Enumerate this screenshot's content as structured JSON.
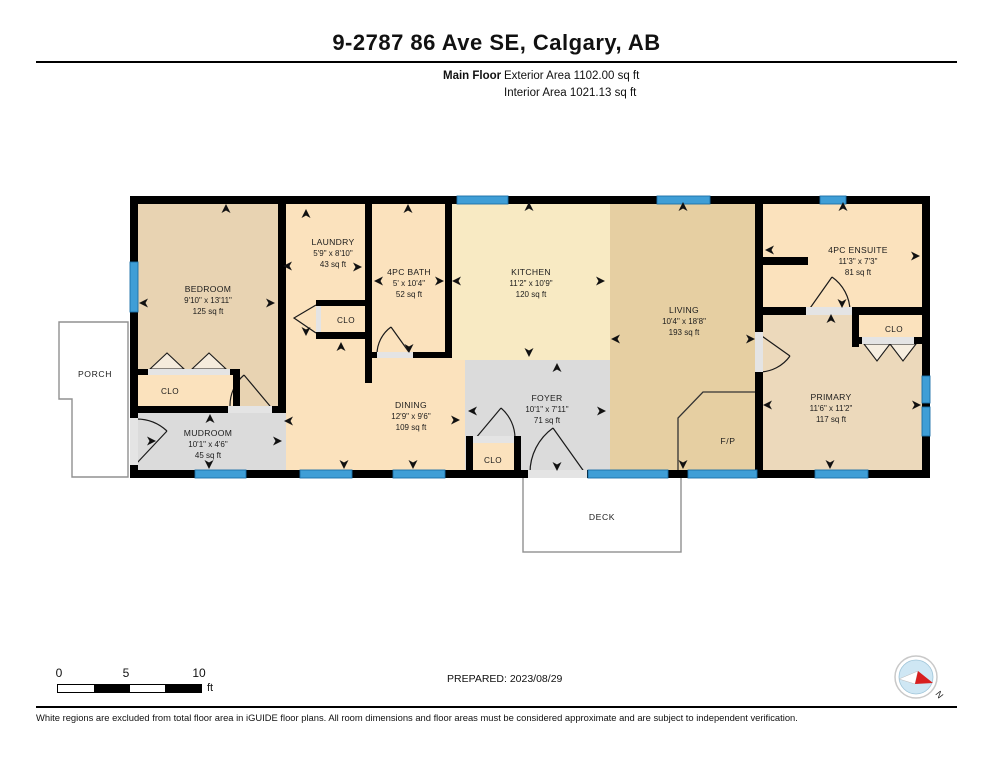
{
  "header": {
    "title": "9-2787 86 Ave SE, Calgary, AB",
    "floor_label": "Main Floor",
    "exterior_area": "Exterior Area 1102.00 sq ft",
    "interior_area": "Interior Area 1021.13 sq ft"
  },
  "plan": {
    "rooms": [
      {
        "name": "BEDROOM",
        "dims": "9'10\" x 13'11\"",
        "area": "125 sq ft"
      },
      {
        "name": "LAUNDRY",
        "dims": "5'9\" x 8'10\"",
        "area": "43 sq ft"
      },
      {
        "name": "4PC BATH",
        "dims": "5' x 10'4\"",
        "area": "52 sq ft"
      },
      {
        "name": "KITCHEN",
        "dims": "11'2\" x 10'9\"",
        "area": "120 sq ft"
      },
      {
        "name": "LIVING",
        "dims": "10'4\" x 18'8\"",
        "area": "193 sq ft"
      },
      {
        "name": "4PC ENSUITE",
        "dims": "11'3\" x 7'3\"",
        "area": "81 sq ft"
      },
      {
        "name": "PRIMARY",
        "dims": "11'6\" x 11'2\"",
        "area": "117 sq ft"
      },
      {
        "name": "DINING",
        "dims": "12'9\" x 9'6\"",
        "area": "109 sq ft"
      },
      {
        "name": "FOYER",
        "dims": "10'1\" x 7'11\"",
        "area": "71 sq ft"
      },
      {
        "name": "MUDROOM",
        "dims": "10'1\" x 4'6\"",
        "area": "45 sq ft"
      }
    ],
    "labels": {
      "closet": "CLO",
      "porch": "PORCH",
      "deck": "DECK",
      "fireplace": "F/P"
    },
    "arrows": [
      {
        "x": 226,
        "y": 209,
        "d": "up"
      },
      {
        "x": 144,
        "y": 303,
        "d": "left"
      },
      {
        "x": 270,
        "y": 303,
        "d": "right"
      },
      {
        "x": 210,
        "y": 419,
        "d": "up"
      },
      {
        "x": 209,
        "y": 464,
        "d": "down"
      },
      {
        "x": 277,
        "y": 441,
        "d": "right"
      },
      {
        "x": 151,
        "y": 441,
        "d": "right"
      },
      {
        "x": 306,
        "y": 214,
        "d": "up"
      },
      {
        "x": 288,
        "y": 266,
        "d": "left"
      },
      {
        "x": 357,
        "y": 267,
        "d": "right"
      },
      {
        "x": 306,
        "y": 331,
        "d": "down"
      },
      {
        "x": 341,
        "y": 347,
        "d": "up"
      },
      {
        "x": 408,
        "y": 209,
        "d": "up"
      },
      {
        "x": 379,
        "y": 281,
        "d": "left"
      },
      {
        "x": 439,
        "y": 281,
        "d": "right"
      },
      {
        "x": 409,
        "y": 348,
        "d": "down"
      },
      {
        "x": 529,
        "y": 207,
        "d": "up"
      },
      {
        "x": 457,
        "y": 281,
        "d": "left"
      },
      {
        "x": 600,
        "y": 281,
        "d": "right"
      },
      {
        "x": 529,
        "y": 352,
        "d": "down"
      },
      {
        "x": 557,
        "y": 368,
        "d": "up"
      },
      {
        "x": 473,
        "y": 411,
        "d": "left"
      },
      {
        "x": 601,
        "y": 411,
        "d": "right"
      },
      {
        "x": 557,
        "y": 466,
        "d": "down"
      },
      {
        "x": 289,
        "y": 421,
        "d": "left"
      },
      {
        "x": 455,
        "y": 420,
        "d": "right"
      },
      {
        "x": 344,
        "y": 464,
        "d": "down"
      },
      {
        "x": 413,
        "y": 464,
        "d": "down"
      },
      {
        "x": 683,
        "y": 207,
        "d": "up"
      },
      {
        "x": 616,
        "y": 339,
        "d": "left"
      },
      {
        "x": 750,
        "y": 339,
        "d": "right"
      },
      {
        "x": 683,
        "y": 464,
        "d": "down"
      },
      {
        "x": 843,
        "y": 207,
        "d": "up"
      },
      {
        "x": 770,
        "y": 250,
        "d": "left"
      },
      {
        "x": 915,
        "y": 256,
        "d": "right"
      },
      {
        "x": 842,
        "y": 303,
        "d": "down"
      },
      {
        "x": 831,
        "y": 319,
        "d": "up"
      },
      {
        "x": 768,
        "y": 405,
        "d": "left"
      },
      {
        "x": 916,
        "y": 405,
        "d": "right"
      },
      {
        "x": 830,
        "y": 464,
        "d": "down"
      }
    ]
  },
  "footer": {
    "scale": {
      "n0": "0",
      "n5": "5",
      "n10": "10",
      "unit": "ft"
    },
    "prepared": "PREPARED: 2023/08/29",
    "compass_label": "N",
    "disclaimer": "White regions are excluded from total floor area in iGUIDE floor plans. All room dimensions and floor areas must be considered approximate and are subject to independent verification."
  },
  "colors": {
    "wall": "#000000",
    "window_blue": "#3f9ed6",
    "window_edge": "#1a6fa8",
    "tan_bedroom": "#e8d3b2",
    "tan_living": "#e6cfa2",
    "tan_primary": "#ecd9bb",
    "orange_room": "#fbe2bd",
    "yellow_kitchen": "#f8eac3",
    "gray_room": "#dbdbdb",
    "outline_gray": "#909090"
  }
}
